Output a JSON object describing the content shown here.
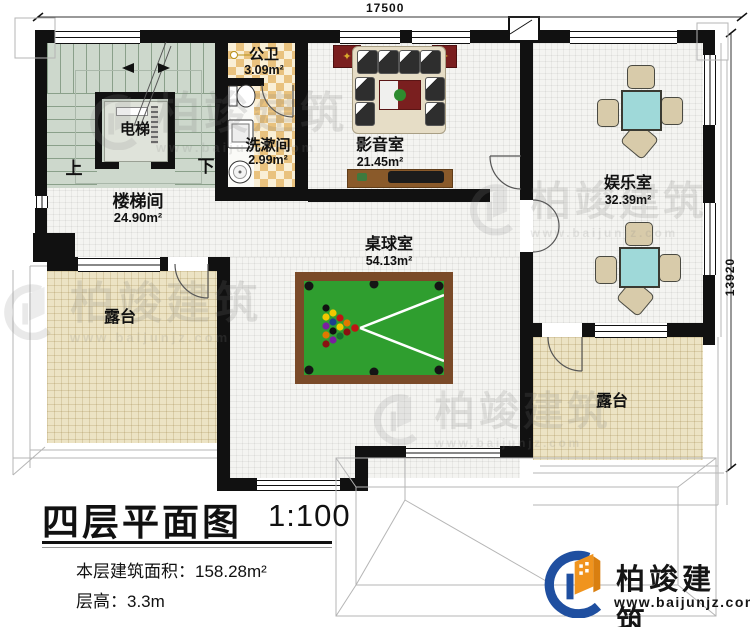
{
  "dimensions": {
    "top": "17500",
    "right": "13920"
  },
  "rooms": [
    {
      "name": "楼梯间",
      "area": "24.90m²"
    },
    {
      "name": "电梯",
      "area": ""
    },
    {
      "name": "公卫",
      "area": "3.09m²"
    },
    {
      "name": "洗漱间",
      "area": "2.99m²"
    },
    {
      "name": "影音室",
      "area": "21.45m²"
    },
    {
      "name": "娱乐室",
      "area": "32.39m²"
    },
    {
      "name": "桌球室",
      "area": "54.13m²"
    },
    {
      "name": "露台",
      "area": ""
    },
    {
      "name": "露台",
      "area": ""
    }
  ],
  "stairs": {
    "up_label": "上",
    "down_label": "下"
  },
  "title_block": {
    "title": "四层平面图",
    "scale": "1:100",
    "floor_area": "本层建筑面积：158.28m²",
    "floor_height": "层高：3.3m"
  },
  "brand": {
    "name": "柏竣建筑",
    "website": "www.baijunjz.com"
  },
  "icons": {
    "star": "✦"
  },
  "colors": {
    "wall": "#111111",
    "floor": "#f4f4f1",
    "terrace": "#ece3c4",
    "stairs": "#cdd8cc",
    "checker_dark": "#e9c27e",
    "checker_light": "#f9efd6",
    "pool_felt": "#2f9e2f",
    "pool_frame": "#7a4a28",
    "table_cyan": "#9fd9d9",
    "chair": "#d8cbaa",
    "sofa": "#e6ddc6",
    "accent_red": "#7a1f1f",
    "logo_orange": "#f0941e",
    "logo_blue": "#1f4fa0"
  }
}
